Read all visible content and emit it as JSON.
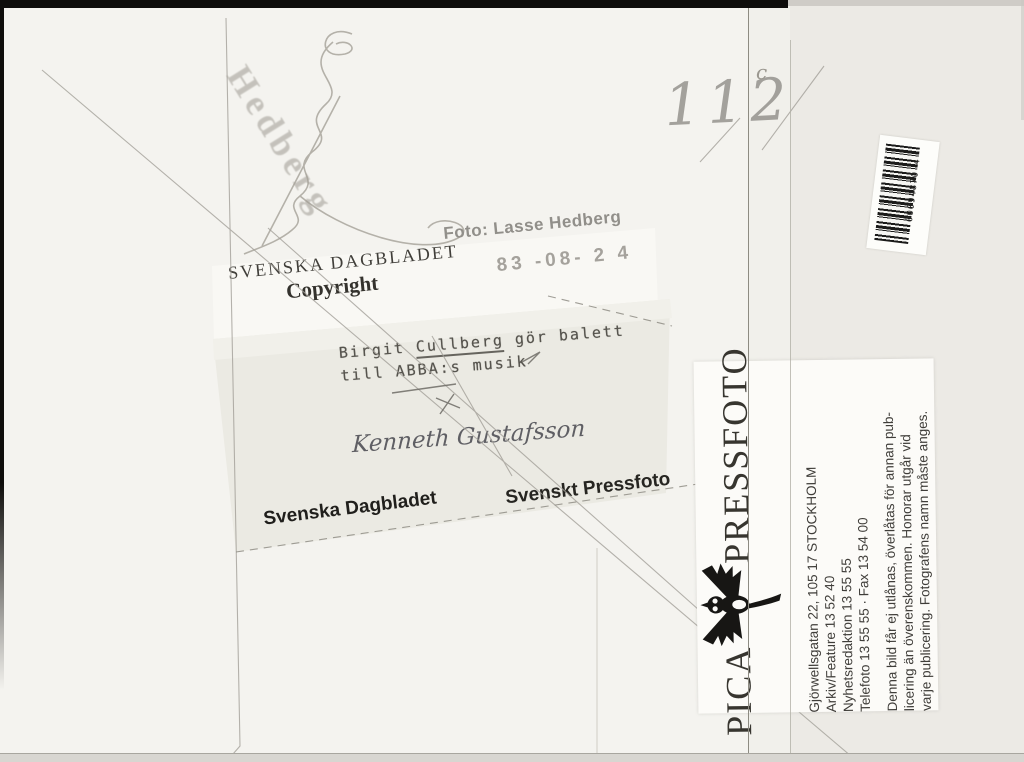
{
  "scan": {
    "pencil_number": "112",
    "pencil_mark": "c",
    "photographer_signature": "Hedberg",
    "stamps": {
      "agency_line1": "SVENSKA DAGBLADET",
      "agency_line2": "Copyright",
      "photo_credit": "Foto: Lasse Hedberg",
      "date": "83 -08- 2 4"
    },
    "caption": {
      "line1_pre": "Birgit ",
      "line1_underlined": "Cullberg",
      "line1_post": " gör balett",
      "line2": "till ABBA:s musik"
    },
    "handwritten_name": "Kenneth Gustafsson",
    "label_bottom_left": "Svenska Dagbladet",
    "label_bottom_right": "Svenskt Pressfoto",
    "barcode": {
      "number": "00094870 4"
    },
    "pica_label": {
      "brand_word1": "PICA",
      "brand_word2": "PRESSFOTO",
      "address_lines": [
        "Gjörwellsgatan 22, 105 17 STOCKHOLM",
        "Arkiv/Feature 13 52 40",
        "Nyhetsredaktion 13 55 55",
        "Telefoto 13 55 55 · Fax 13 54 00"
      ],
      "disclaimer_lines": [
        "Denna bild får ej utlånas, överlåtas för annan pub-",
        "licering än överenskommen. Honorar utgår vid",
        "varje publicering. Fotografens namn måste anges."
      ]
    },
    "colors": {
      "paper": "#f4f3ef",
      "label_tint": "#eaeae2",
      "pencil": "#9b988f",
      "stamp_gray": "#95928c",
      "ink_black": "#2e2c29"
    }
  }
}
